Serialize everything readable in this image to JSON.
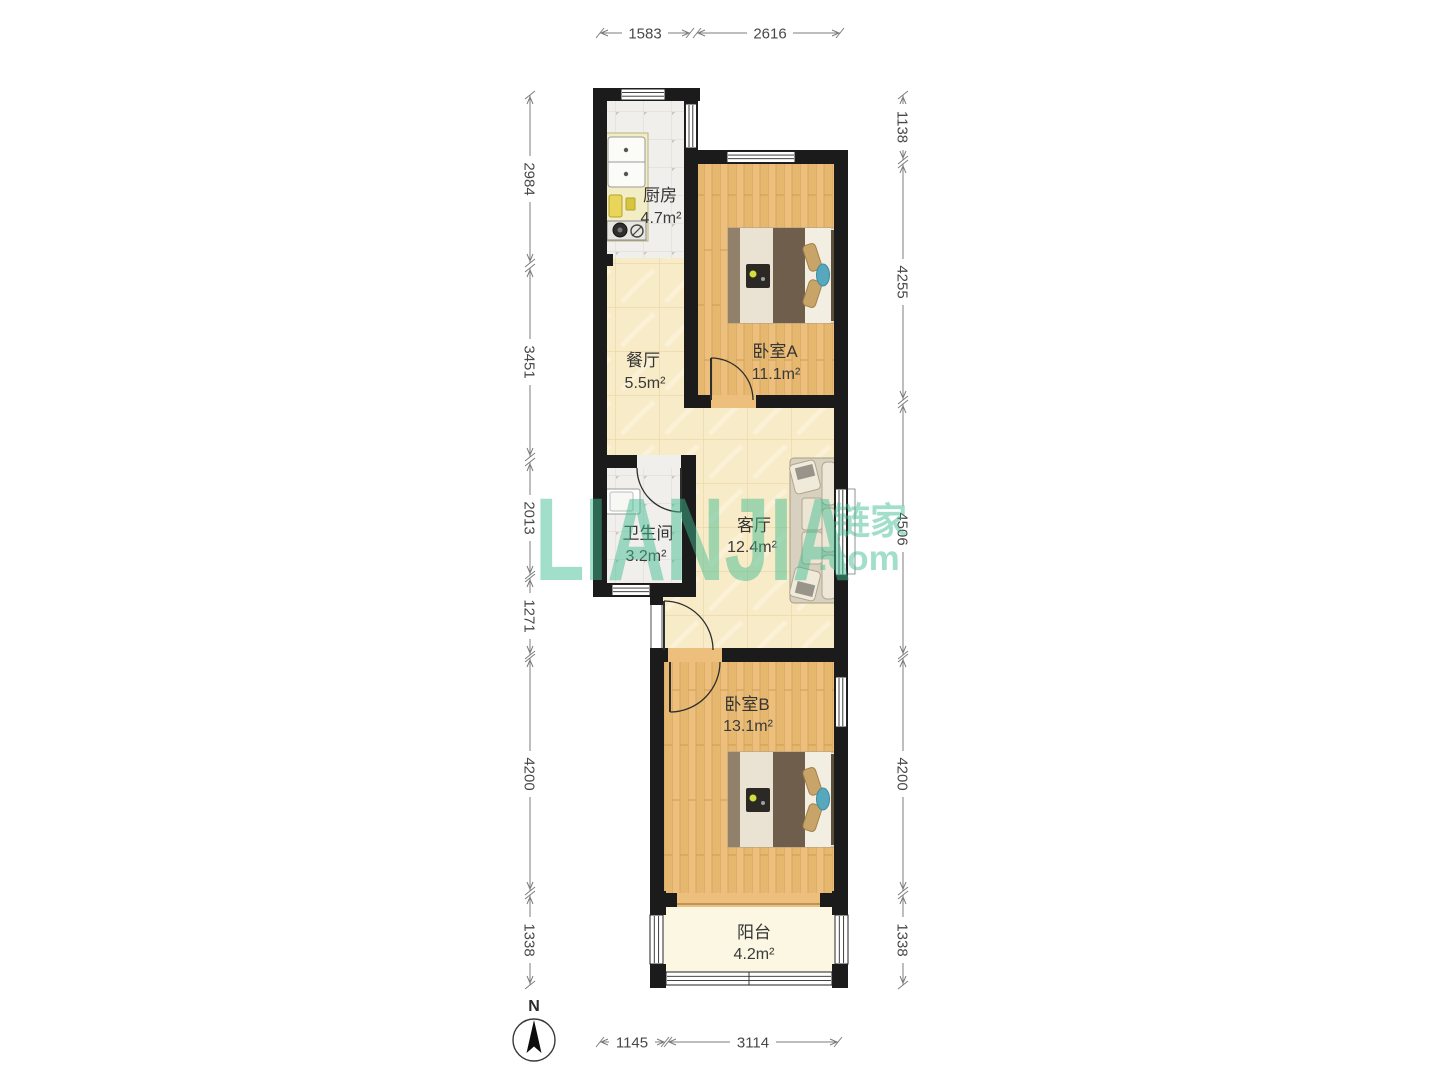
{
  "watermark": {
    "main": "LIANJIA",
    "cn": "链家",
    "com": ".com",
    "color": "#3fbd92"
  },
  "compass": {
    "label": "N"
  },
  "rooms": {
    "kitchen": {
      "name": "厨房",
      "area": "4.7m²"
    },
    "dining": {
      "name": "餐厅",
      "area": "5.5m²"
    },
    "bedroomA": {
      "name": "卧室A",
      "area": "11.1m²"
    },
    "bathroom": {
      "name": "卫生间",
      "area": "3.2m²"
    },
    "living": {
      "name": "客厅",
      "area": "12.4m²"
    },
    "bedroomB": {
      "name": "卧室B",
      "area": "13.1m²"
    },
    "balcony": {
      "name": "阳台",
      "area": "4.2m²"
    }
  },
  "dimensions": {
    "top": [
      "1583",
      "2616"
    ],
    "left": [
      "2984",
      "3451",
      "2013",
      "1271",
      "4200",
      "1338"
    ],
    "right": [
      "1138",
      "4255",
      "4506",
      "4200",
      "1338"
    ],
    "bottom": [
      "1145",
      "3114"
    ]
  }
}
